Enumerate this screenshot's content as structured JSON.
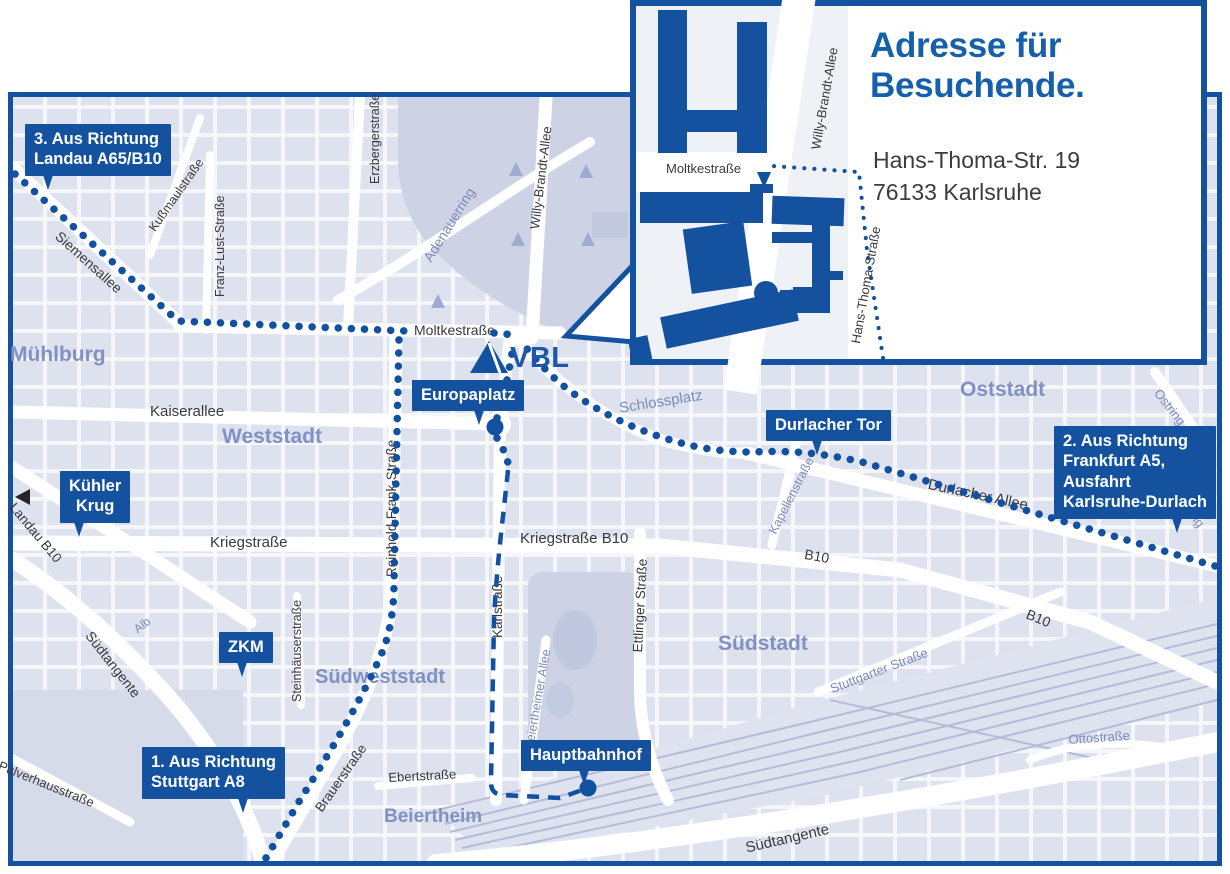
{
  "colors": {
    "primary_blue": "#1452a0",
    "route_blue": "#11519f",
    "map_background": "#dde2ee",
    "park_fill": "#cdd3e5",
    "area_label": "#8191c1",
    "street_label": "#3a3a3e",
    "title_blue": "#1560ab",
    "rail_line": "#b3bdd8"
  },
  "logo": {
    "text": "VBL"
  },
  "badges": {
    "route3": "3. Aus Richtung\nLandau A65/B10",
    "route2": "2. Aus Richtung\nFrankfurt A5,\nAusfahrt\nKarlsruhe-Durlach",
    "route1": "1. Aus Richtung\nStuttgart A8",
    "europaplatz": "Europaplatz",
    "durlacher_tor": "Durlacher Tor",
    "kuehler_krug": "Kühler\nKrug",
    "zkm": "ZKM",
    "hauptbahnhof": "Hauptbahnhof"
  },
  "streets": {
    "siemensallee": "Siemensallee",
    "kussmaulstrasse": "Kußmaulstraße",
    "franz_lust_strasse": "Franz-Lust-Straße",
    "erzbergerstrasse": "Erzbergerstraße",
    "adenauerring": "Adenauerring",
    "willy_brandt_allee": "Willy-Brandt-Allee",
    "moltkestrasse": "Moltkestraße",
    "kaiserallee": "Kaiserallee",
    "reinhold_frank_strasse": "Reinhold-Frank-Straße",
    "kriegstrasse": "Kriegstraße",
    "kriegstrasse_b10": "Kriegstraße B10",
    "b10_east": "B10",
    "b10_southeast": "B10",
    "karlstrasse": "Karlstraße",
    "ettlinger_strasse": "Ettlinger Straße",
    "beiertheimer_allee": "Beiertheimer Allee",
    "steinhaeuserstrasse": "Steinhäuserstraße",
    "brauerstrasse": "Brauerstraße",
    "ebertstrasse": "Ebertstraße",
    "pulverhausstrasse": "Pulverhausstraße",
    "suedtangente_west": "Südtangente",
    "suedtangente_south": "Südtangente",
    "stuttgarter_strasse": "Stuttgarter Straße",
    "ottostrasse": "Ottostraße",
    "durlacher_allee": "Durlacher Allee",
    "kapellenstrasse": "Kapellenstraße",
    "ostring_north": "Ostring",
    "ostring_south": "Ostring",
    "landau_b10": "Landau B10",
    "alb": "Alb"
  },
  "areas": {
    "muehlburg": "Mühlburg",
    "weststadt": "Weststadt",
    "oststadt": "Oststadt",
    "suedstadt": "Südstadt",
    "suedweststadt": "Südweststadt",
    "beiertheim": "Beiertheim",
    "schlossplatz": "Schlossplatz"
  },
  "inset": {
    "title": "Adresse für\nBesuchende.",
    "address": "Hans-Thoma-Str. 19\n76133 Karlsruhe",
    "streets": {
      "moltkestrasse": "Moltkestraße",
      "willy_brandt_allee": "Willy-Brandt-Allee",
      "hans_thoma_strasse": "Hans-Thoma-Straße"
    }
  }
}
